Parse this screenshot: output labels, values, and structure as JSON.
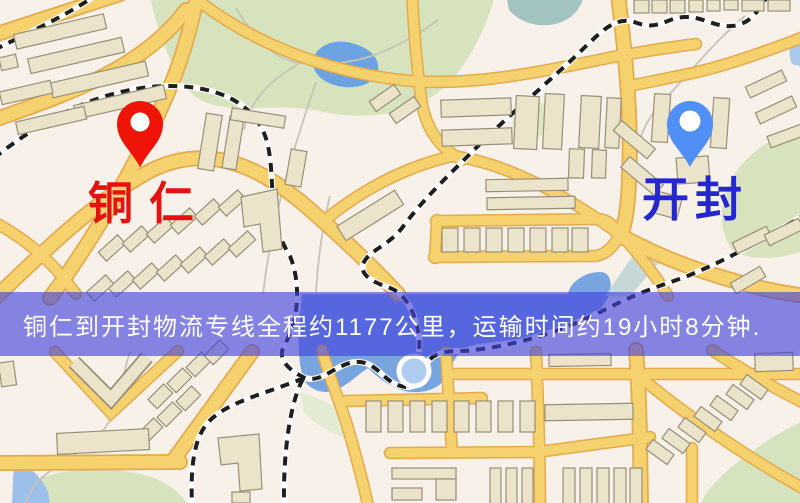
{
  "banner": {
    "text": "铜仁到开封物流专线全程约1177公里，运输时间约19小时8分钟."
  },
  "markers": {
    "origin": {
      "label": "铜仁",
      "pin_color": "#ee1508",
      "pin_hole_color": "#ffffff",
      "label_color": "#e21310"
    },
    "destination": {
      "label": "开封",
      "pin_color": "#4f8ff6",
      "pin_hole_color": "#ffffff",
      "label_color": "#2427ce"
    }
  },
  "map_colors": {
    "background": "#f7f1ea",
    "road_fill": "#f6d26e",
    "road_border": "#e2ab4e",
    "park_green": "#d6e3bd",
    "water_blue": "#78a4e0",
    "pond_blue": "#6ba3e2",
    "building_fill": "#ebe3ca",
    "building_border": "#978f77",
    "railway_dash": "#1e1e1e",
    "railway_casing": "#fdfdfd",
    "banner_background": "rgba(67,66,220,0.63)",
    "banner_text_color": "#ffffff"
  }
}
